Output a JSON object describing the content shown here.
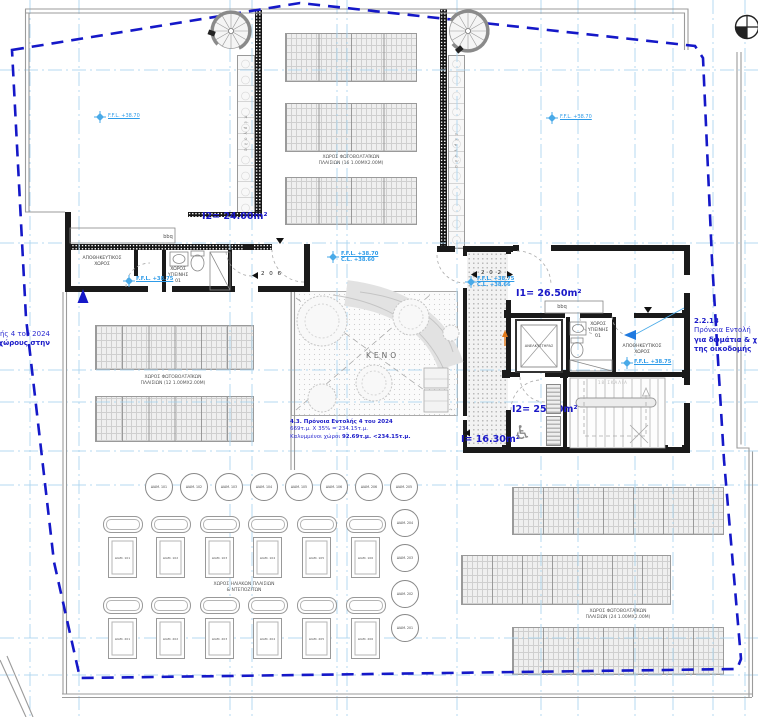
{
  "colors": {
    "boundary": "#1518c8",
    "grid": "#a9d4ef",
    "area_label": "#1a18c8",
    "ffl_blue": "#2e9be8",
    "note_blue": "#2a2ad0",
    "section_orange": "#e07818"
  },
  "notes": {
    "left_cut": {
      "line1": "ής 4 του 2024",
      "line2": "χώρους στην"
    },
    "provision_43": {
      "line1": "4.3. Πρόνοια Εντολής 4 του 2024",
      "line2": "669τ.μ. Χ 35% = 234.15τ.μ.",
      "line3a": "Καλυμμένοι χώροι ",
      "line3b": "92.69τ.μ. <234.15τ.μ."
    },
    "order_2218": {
      "ref": "2.2.18",
      "line1": "Πρόνοια Εντολή",
      "line2": "για δωμάτια & χ",
      "line3": "της οικοδομής"
    }
  },
  "levels": {
    "ffl_3870": "F.F.L. +38.70",
    "cl_3860": "C.L. +38.60",
    "ffl_3875": "F.F.L. +38.75",
    "cl_3866": "C.L. +38.66"
  },
  "areas": {
    "i2_roof": "I2= 24.00m²",
    "i1": "I1= 26.50m²",
    "i2_stair": "I2= 25.80m²",
    "i_land": "I= 16.30m²"
  },
  "rooms": {
    "storage": "ΑΠΟΘΗΚΕΥΤΙΚΟΣ\nΧΩΡΟΣ",
    "wc": "ΧΩΡΟΣ\nΥΓΙΕΙΝΗΣ\n01",
    "elevator": "ΑΝΕΛΚΥΣΤΗΡΑΣ",
    "void": "ΚΕΝΟ",
    "bbq": "bbq",
    "stairs_note": "18 ΣΚΑΛΙΑ",
    "pergola": "πέργολα"
  },
  "pv": {
    "top": "ΧΩΡΟΣ ΦΩΤΟΒΟΛΤΑΪΚΩΝ\nΠΛΑΙΣΙΩΝ (16 1.00ΜΧ2.00Μ)",
    "left": "ΧΩΡΟΣ ΦΩΤΟΒΟΛΤΑΪΚΩΝ\nΠΛΑΙΣΙΩΝ (12 1.00ΜΧ2.00Μ)",
    "bottom_right": "ΧΩΡΟΣ ΦΩΤΟΒΟΛΤΑΪΚΩΝ\nΠΛΑΙΣΙΩΝ (24 1.00ΜΧ2.00Μ)",
    "solar": "ΧΩΡΟΣ ΗΛΙΑΚΩΝ ΠΛΑΙΣΙΩΝ\n& ΝΤΕΠΟΖΙΤΩΝ"
  },
  "doors": {
    "d206": "2 0 6",
    "d202": "2 0 2"
  },
  "vents": [
    "ΔΙΑΜ. 101",
    "ΔΙΑΜ. 102",
    "ΔΙΑΜ. 103",
    "ΔΙΑΜ. 104",
    "ΔΙΑΜ. 105",
    "ΔΙΑΜ. 106",
    "ΔΙΑΜ. 206",
    "ΔΙΑΜ. 205",
    "ΔΙΑΜ. 204",
    "ΔΙΑΜ. 203",
    "ΔΙΑΜ. 202",
    "ΔΙΑΜ. 201"
  ],
  "heaters": {
    "row1": [
      "ΔΙΑΜ. 101",
      "ΔΙΑΜ. 102",
      "ΔΙΑΜ. 103",
      "ΔΙΑΜ. 104",
      "ΔΙΑΜ. 105",
      "ΔΙΑΜ. 106"
    ],
    "row2": [
      "ΔΙΑΜ. 201",
      "ΔΙΑΜ. 202",
      "ΔΙΑΜ. 203",
      "ΔΙΑΜ. 204",
      "ΔΙΑΜ. 205",
      "ΔΙΑΜ. 206"
    ]
  }
}
